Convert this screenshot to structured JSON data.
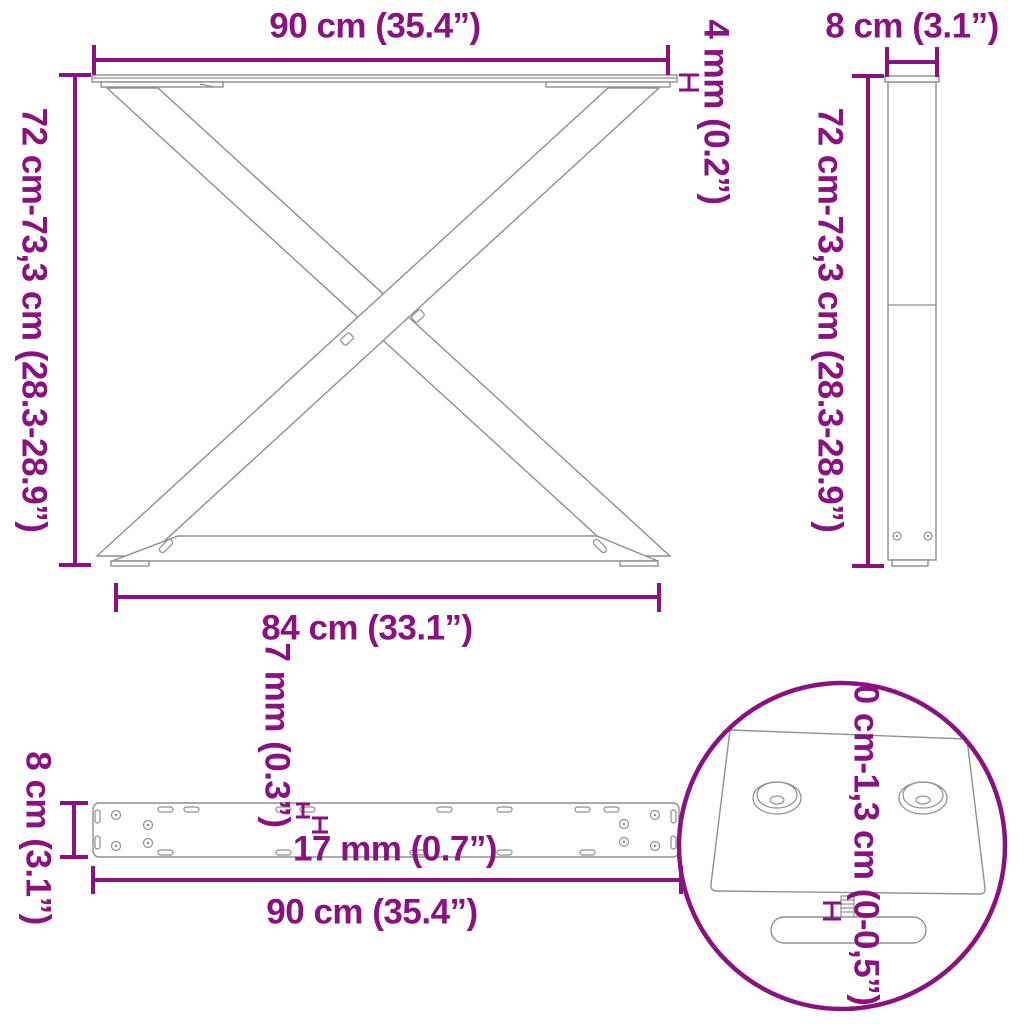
{
  "title": "X-shaped table legs dimension diagram",
  "colors": {
    "dimension_accent": "#8A1280",
    "product_outline": "#8f8f8f",
    "background": "#ffffff"
  },
  "views": {
    "front": {
      "name": "front view of X-frame leg",
      "top_width": "90 cm (35.4”)",
      "height_range": "72 cm-73,3 cm (28.3-28.9”)",
      "top_plate_thickness": "4 mm (0.2”)",
      "base_width": "84 cm (33.1”)"
    },
    "side": {
      "name": "side profile view",
      "width": "8 cm (3.1”)",
      "height_range": "72 cm-73,3 cm (28.3-28.9”)"
    },
    "top": {
      "name": "top view of mounting bar",
      "depth": "8 cm (3.1”)",
      "hole_width": "7 mm (0.3”)",
      "hole_length": "17 mm (0.7”)",
      "length": "90 cm (35.4”)"
    },
    "detail": {
      "name": "adjustable foot detail",
      "adjustment_range": "0 cm-1,3 cm (0-0,5”)"
    }
  }
}
